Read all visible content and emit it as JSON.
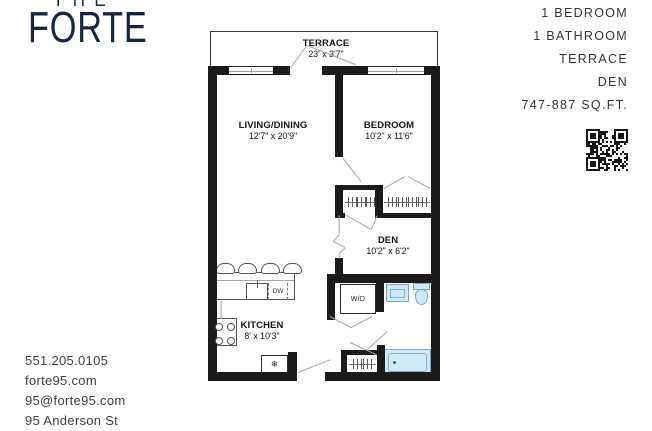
{
  "logo": {
    "line1": "THE",
    "line2": "FORTE"
  },
  "summary": {
    "items": [
      "1 BEDROOM",
      "1 BATHROOM",
      "TERRACE",
      "DEN",
      "747-887 SQ.FT."
    ]
  },
  "contact": {
    "phone": "551.205.0105",
    "website": "forte95.com",
    "email": "95@forte95.com",
    "address": "95 Anderson St"
  },
  "floorplan": {
    "rooms": [
      {
        "name": "TERRACE",
        "dims": "23' x 3'7\""
      },
      {
        "name": "LIVING/DINING",
        "dims": "12'7\" x 20'9\""
      },
      {
        "name": "BEDROOM",
        "dims": "10'2\" x 11'6\""
      },
      {
        "name": "DEN",
        "dims": "10'2\" x 6'2\""
      },
      {
        "name": "KITCHEN",
        "dims": "8' x 10'3\""
      }
    ],
    "labels": {
      "washer_dryer": "W/D",
      "dishwasher": "DW"
    },
    "icons": {
      "fridge_glyph": "❄"
    },
    "colors": {
      "wall": "#1b1b1b",
      "fixture_fill": "#cfe9f7",
      "fixture_line": "#6fa9cc",
      "logo": "#16263f"
    }
  }
}
